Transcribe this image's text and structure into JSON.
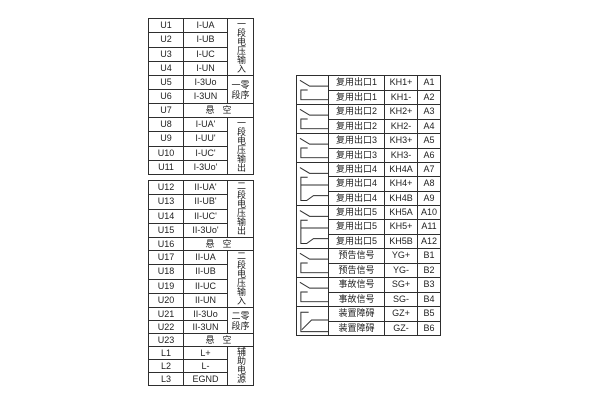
{
  "colors": {
    "line": "#2e2e2e",
    "background": "#ffffff"
  },
  "left_blocks": [
    {
      "name": "voltage-terminal-block-1",
      "segments": [
        {
          "type": "group",
          "label": "一段电压输入",
          "label_layout": "vertical",
          "rows": [
            [
              "U1",
              "I-UA"
            ],
            [
              "U2",
              "I-UB"
            ],
            [
              "U3",
              "I-UC"
            ],
            [
              "U4",
              "I-UN"
            ]
          ]
        },
        {
          "type": "group",
          "label": "一段零序",
          "label_layout": "grid",
          "label_display": [
            "一零",
            "段序"
          ],
          "rows": [
            [
              "U5",
              "I-3Uo"
            ],
            [
              "U6",
              "I-3UN"
            ]
          ]
        },
        {
          "type": "merged",
          "rows": [
            [
              "U7",
              "悬空"
            ]
          ]
        },
        {
          "type": "group",
          "label": "一段电压输出",
          "label_layout": "vertical",
          "rows": [
            [
              "U8",
              "I-UA'"
            ],
            [
              "U9",
              "I-UU'"
            ],
            [
              "U10",
              "I-UC'"
            ],
            [
              "U11",
              "I-3Uo'"
            ]
          ]
        }
      ]
    },
    {
      "name": "voltage-terminal-block-2",
      "segments": [
        {
          "type": "group",
          "label": "二段电压输出",
          "label_layout": "vertical",
          "rows": [
            [
              "U12",
              "II-UA'"
            ],
            [
              "U13",
              "II-UB'"
            ],
            [
              "U14",
              "II-UC'"
            ],
            [
              "U15",
              "II-3Uo'"
            ]
          ]
        },
        {
          "type": "merged",
          "rows": [
            [
              "U16",
              "悬空"
            ]
          ]
        },
        {
          "type": "group",
          "label": "二段电压输入",
          "label_layout": "vertical",
          "rows": [
            [
              "U17",
              "II-UA"
            ],
            [
              "U18",
              "II-UB"
            ],
            [
              "U19",
              "II-UC"
            ],
            [
              "U20",
              "II-UN"
            ]
          ]
        },
        {
          "type": "group",
          "label": "二段零序",
          "label_layout": "grid",
          "label_display": [
            "二零",
            "段序"
          ],
          "rows": [
            [
              "U21",
              "II-3Uo"
            ],
            [
              "U22",
              "II-3UN"
            ]
          ]
        },
        {
          "type": "merged",
          "rows": [
            [
              "U23",
              "悬空"
            ]
          ]
        },
        {
          "type": "group",
          "label": "辅助电源",
          "label_layout": "vertical",
          "rows": [
            [
              "L1",
              "L+"
            ],
            [
              "L2",
              "L-"
            ],
            [
              "L3",
              "EGND"
            ]
          ]
        }
      ]
    }
  ],
  "right_table": {
    "name": "output-contact-table",
    "groups": [
      {
        "label": "复用出口1",
        "symbol": "no-contact",
        "rows": [
          [
            "KH1+",
            "A1"
          ],
          [
            "KH1-",
            "A2"
          ]
        ]
      },
      {
        "label": "复用出口2",
        "symbol": "no-contact",
        "rows": [
          [
            "KH2+",
            "A3"
          ],
          [
            "KH2-",
            "A4"
          ]
        ]
      },
      {
        "label": "复用出口3",
        "symbol": "no-contact",
        "rows": [
          [
            "KH3+",
            "A5"
          ],
          [
            "KH3-",
            "A6"
          ]
        ]
      },
      {
        "label": "复用出口4",
        "symbol": "changeover-contact",
        "rows": [
          [
            "KH4A",
            "A7"
          ],
          [
            "KH4+",
            "A8"
          ],
          [
            "KH4B",
            "A9"
          ]
        ]
      },
      {
        "label": "复用出口5",
        "symbol": "changeover-contact",
        "rows": [
          [
            "KH5A",
            "A10"
          ],
          [
            "KH5+",
            "A11"
          ],
          [
            "KH5B",
            "A12"
          ]
        ]
      },
      {
        "label": "预告信号",
        "symbol": "no-contact",
        "rows": [
          [
            "YG+",
            "B1"
          ],
          [
            "YG-",
            "B2"
          ]
        ]
      },
      {
        "label": "事故信号",
        "symbol": "no-contact",
        "rows": [
          [
            "SG+",
            "B3"
          ],
          [
            "SG-",
            "B4"
          ]
        ]
      },
      {
        "label": "装置障碍",
        "symbol": "nc-contact",
        "rows": [
          [
            "GZ+",
            "B5"
          ],
          [
            "GZ-",
            "B6"
          ]
        ]
      }
    ]
  }
}
